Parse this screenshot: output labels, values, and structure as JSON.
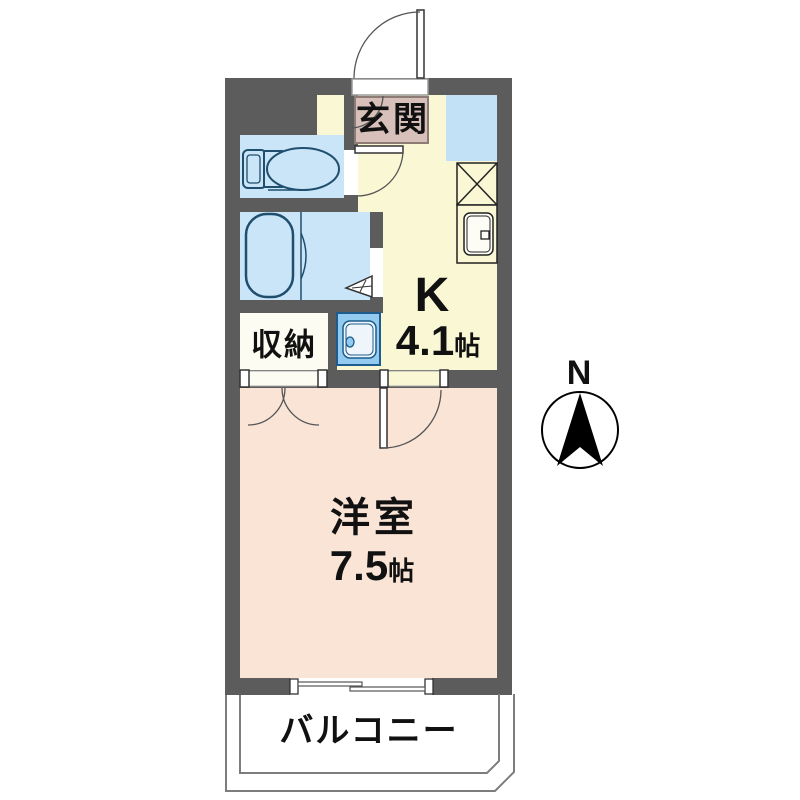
{
  "floorplan": {
    "entrance": {
      "label": "玄関"
    },
    "storage": {
      "label": "収納"
    },
    "kitchen": {
      "label": "K",
      "size": "4.1",
      "unit": "帖"
    },
    "western_room": {
      "label": "洋室",
      "size": "7.5",
      "unit": "帖"
    },
    "balcony": {
      "label": "バルコニー"
    },
    "compass": {
      "north_label": "N"
    },
    "colors": {
      "wall": "#5c5c5c",
      "kitchen_floor": "#f9f7d4",
      "western_room_floor": "#f9e4d6",
      "wet_area_blue": "#c9e5f7",
      "entrance_floor": "#d7c0ba",
      "fixture_blue": "#93cbf0",
      "storage_floor": "#fdfcf2"
    }
  }
}
